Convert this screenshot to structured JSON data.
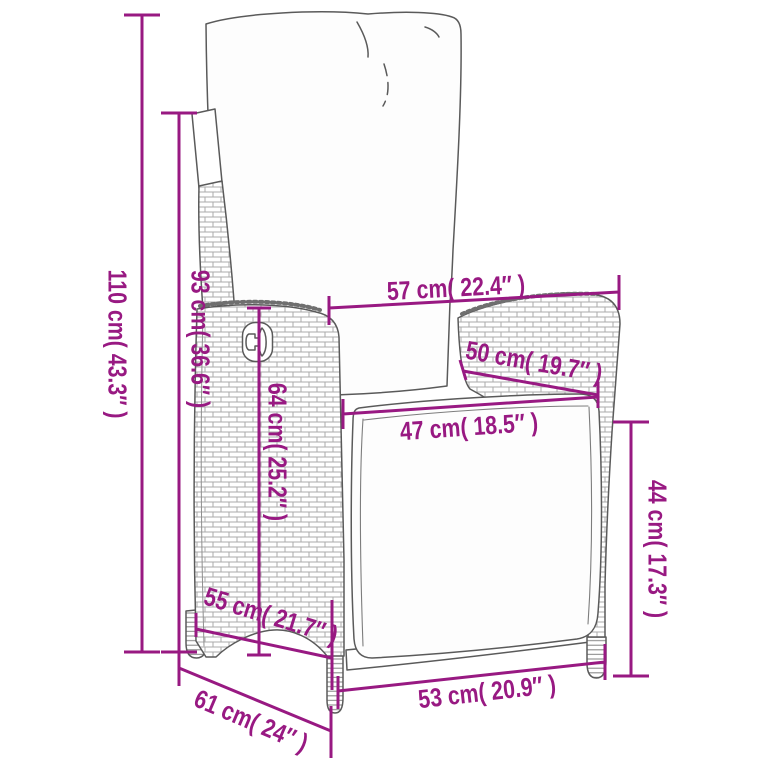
{
  "page": {
    "background": "#ffffff",
    "width_px": 767,
    "height_px": 767
  },
  "diagram": {
    "kind": "product dimension line drawing",
    "subject": "reclining poly rattan garden chair with cushions",
    "accent_color": "#981982",
    "outline_color": "#5a5a5a",
    "dimensions": [
      {
        "id": "total-height",
        "label": "110 cm( 43.3″ )",
        "cm": 110,
        "inches": 43.3
      },
      {
        "id": "back-height",
        "label": "93 cm( 36.6″ )",
        "cm": 93,
        "inches": 36.6
      },
      {
        "id": "top-width",
        "label": "57 cm( 22.4″ )",
        "cm": 57,
        "inches": 22.4
      },
      {
        "id": "armrest-depth",
        "label": "50 cm( 19.7″ )",
        "cm": 50,
        "inches": 19.7
      },
      {
        "id": "seat-width",
        "label": "47 cm( 18.5″ )",
        "cm": 47,
        "inches": 18.5
      },
      {
        "id": "side-height",
        "label": "64 cm( 25.2″ )",
        "cm": 64,
        "inches": 25.2
      },
      {
        "id": "seat-height",
        "label": "44 cm( 17.3″ )",
        "cm": 44,
        "inches": 17.3
      },
      {
        "id": "seat-depth",
        "label": "55 cm( 21.7″ )",
        "cm": 55,
        "inches": 21.7
      },
      {
        "id": "total-depth",
        "label": "61 cm( 24″ )",
        "cm": 61,
        "inches": 24
      },
      {
        "id": "front-width",
        "label": "53 cm( 20.9″ )",
        "cm": 53,
        "inches": 20.9
      }
    ]
  }
}
